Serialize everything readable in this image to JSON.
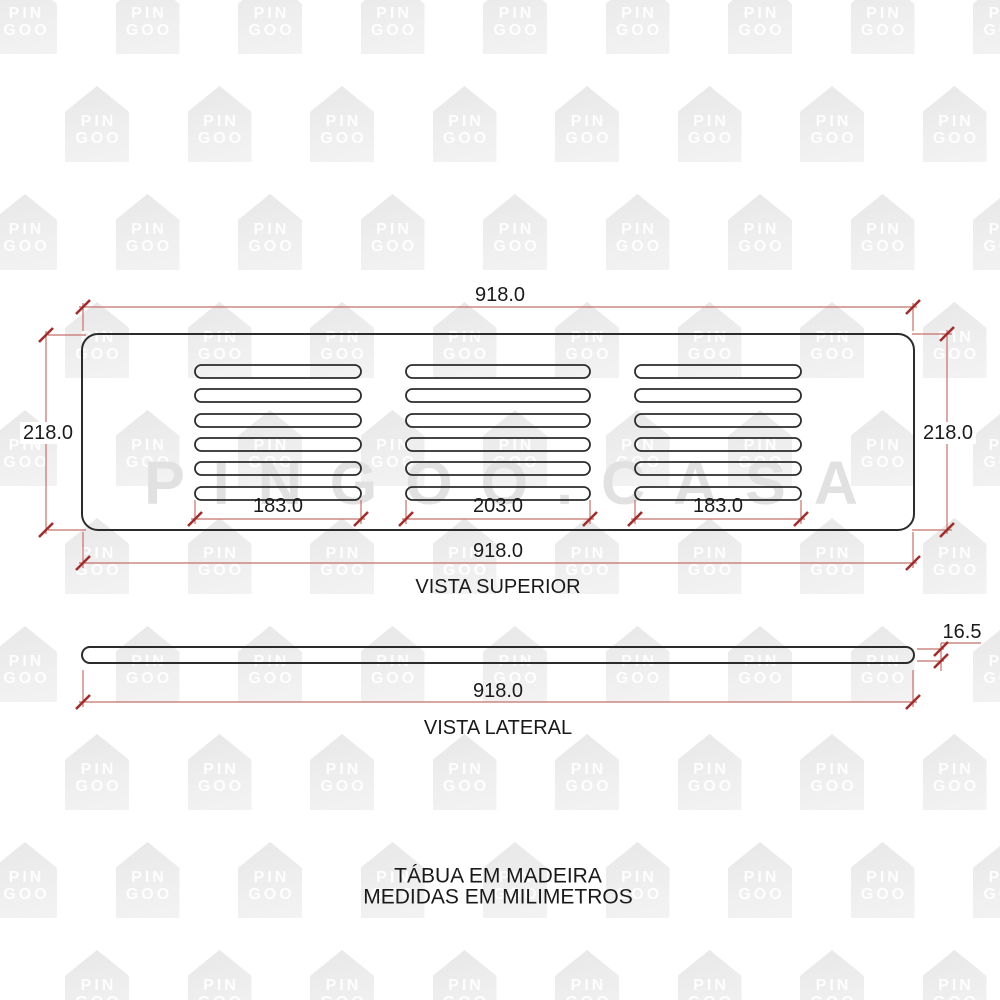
{
  "drawing": {
    "top_view": {
      "title": "VISTA SUPERIOR",
      "width_dim_top": "918.0",
      "width_dim_bottom": "918.0",
      "height_dim_left": "218.0",
      "height_dim_right": "218.0",
      "slot_group_dims": [
        "183.0",
        "203.0",
        "183.0"
      ]
    },
    "side_view": {
      "title": "VISTA LATERAL",
      "width_dim": "918.0",
      "thickness_dim": "16.5"
    },
    "footer": {
      "line1": "TÁBUA EM MADEIRA",
      "line2": "MEDIDAS EM MILIMETROS"
    },
    "colors": {
      "outline": "#2b2b2b",
      "dimension_line": "#c4706b",
      "dimension_tick": "#9e2f2d",
      "text": "#1a1a1a",
      "watermark_house": "#ececec",
      "watermark_text": "#e1e1e1"
    }
  },
  "watermark": {
    "logo_line1": "PIN",
    "logo_line2": "GOO",
    "big_text": "PINGOO.CASA"
  }
}
